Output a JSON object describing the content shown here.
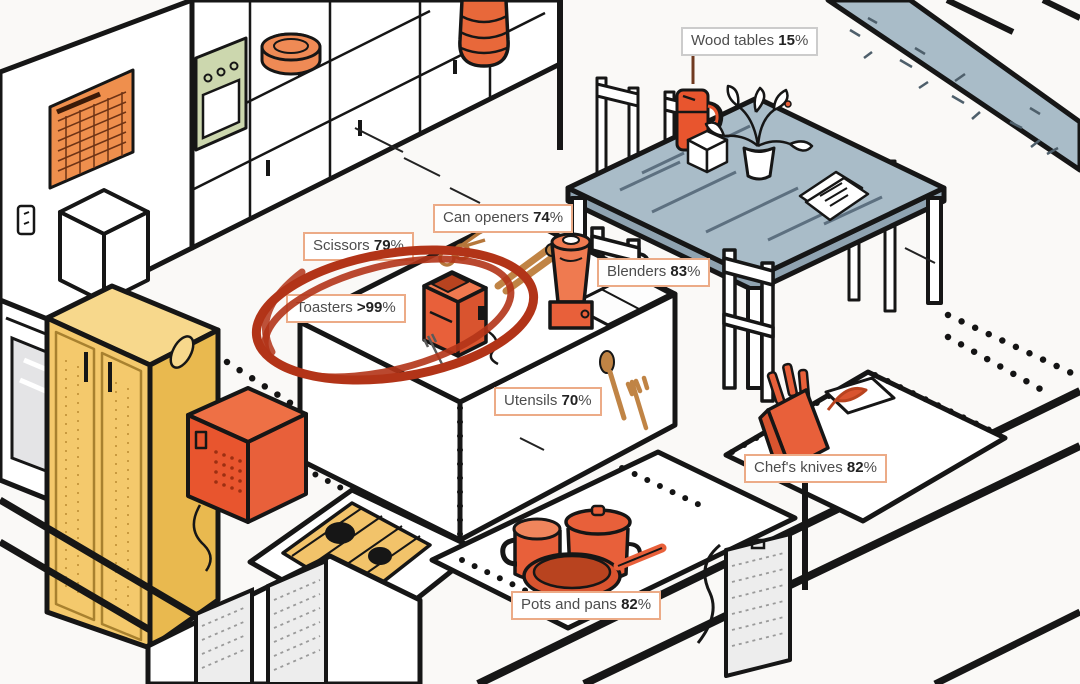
{
  "scene": {
    "description": "Isometric line-art illustration of a kitchen; callout labels show the share of each product category imported, with the toaster circled in red",
    "depicted_objects": [
      "calendar",
      "wall-cabinets",
      "wall-oven",
      "plate-stack",
      "vase",
      "countertop-band",
      "dining-table",
      "chairs",
      "thermos-tumbler",
      "tissue-cube",
      "potted-plant",
      "papers",
      "kitchen-island",
      "scissors",
      "can-opener",
      "toaster",
      "blender",
      "sink",
      "wooden-utensils",
      "oven",
      "refrigerator",
      "microwave",
      "gas-cooktop",
      "dishwasher-panels",
      "pots-and-pans",
      "knife-block",
      "cutting-board",
      "wall-outlet"
    ],
    "colors": {
      "outline": "#161616",
      "orange": "#e8603a",
      "orange_light": "#ef8a55",
      "yellow": "#f4c96c",
      "blue_gray": "#a9bcc8",
      "green": "#ccd7ae",
      "red_circle": "#b23418",
      "label_border": "#ecab87",
      "label_border_muted": "#cccccc",
      "label_text": "#4d4d4d",
      "label_text_bold": "#222222",
      "background": "#faf9f7"
    }
  },
  "labels": [
    {
      "item": "Wood tables",
      "value": "15",
      "pct": "%",
      "variant": "muted",
      "circled": false
    },
    {
      "item": "Can openers",
      "value": "74",
      "pct": "%",
      "variant": "orange",
      "circled": false
    },
    {
      "item": "Scissors",
      "value": "79",
      "pct": "%",
      "variant": "orange",
      "circled": false
    },
    {
      "item": "Toasters",
      "value": ">99",
      "pct": "%",
      "variant": "orange",
      "circled": true
    },
    {
      "item": "Blenders",
      "value": "83",
      "pct": "%",
      "variant": "orange",
      "circled": false
    },
    {
      "item": "Utensils",
      "value": "70",
      "pct": "%",
      "variant": "orange",
      "circled": false
    },
    {
      "item": "Chef's knives",
      "value": "82",
      "pct": "%",
      "variant": "orange",
      "circled": false
    },
    {
      "item": "Pots and pans",
      "value": "82",
      "pct": "%",
      "variant": "orange",
      "circled": false
    }
  ]
}
